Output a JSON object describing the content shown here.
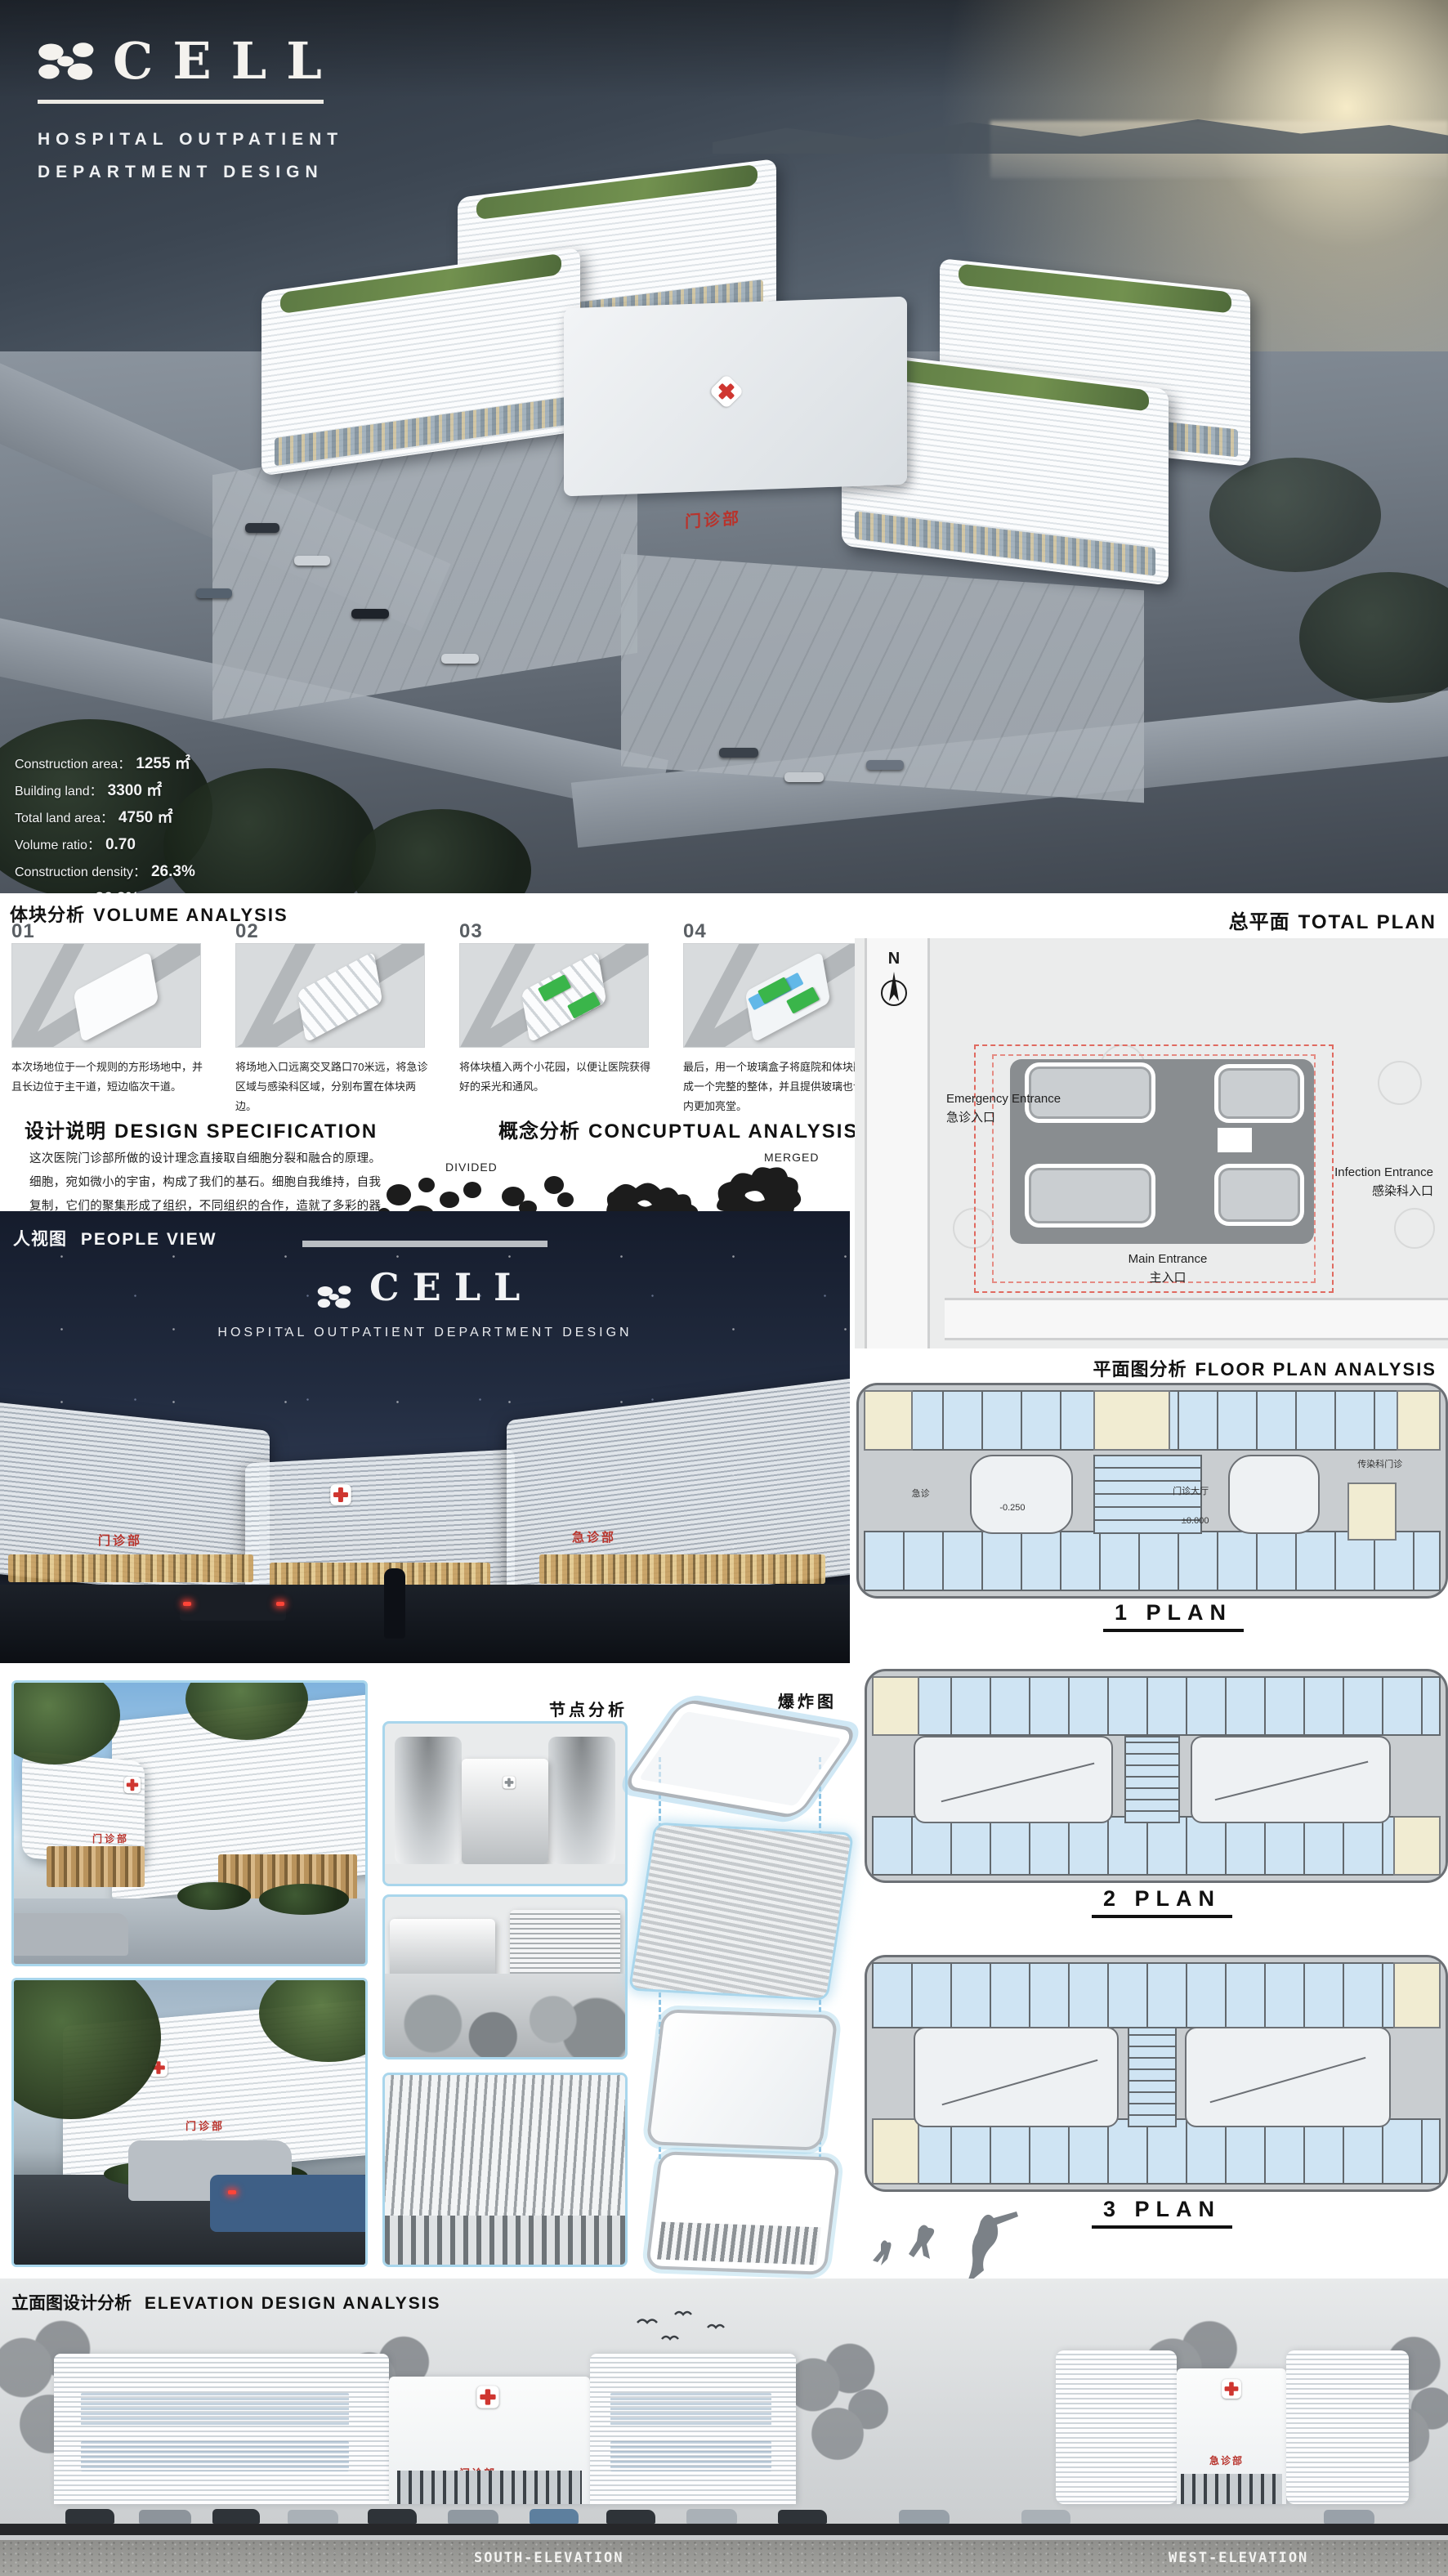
{
  "hero": {
    "logo": {
      "title": "CELL",
      "subtitle_line1": "HOSPITAL OUTPATIENT",
      "subtitle_line2": "DEPARTMENT DESIGN"
    },
    "building_sign": "门诊部",
    "stats": [
      {
        "label": "Construction area：",
        "value": "1255 ㎡"
      },
      {
        "label": "Building land：",
        "value": "3300 ㎡"
      },
      {
        "label": "Total land area：",
        "value": "4750 ㎡"
      },
      {
        "label": "Volume ratio：",
        "value": "0.70"
      },
      {
        "label": "Construction density：",
        "value": "26.3%"
      },
      {
        "label": "Green rate：",
        "value": "36.2%"
      }
    ]
  },
  "volume_analysis": {
    "title_zh": "体块分析",
    "title_en": "VOLUME ANALYSIS",
    "items": [
      {
        "num": "01",
        "caption": "本次场地位于一个规则的方形场地中，并且长边位于主干道，短边临次干道。"
      },
      {
        "num": "02",
        "caption": "将场地入口远离交叉路口70米远，将急诊区域与感染科区域，分别布置在体块两边。"
      },
      {
        "num": "03",
        "caption": "将体块植入两个小花园，以便让医院获得好的采光和通风。"
      },
      {
        "num": "04",
        "caption": "最后，用一个玻璃盒子将庭院和体块融合成一个完整的整体，并且提供玻璃也让室内更加亮堂。"
      }
    ]
  },
  "design_spec": {
    "title_zh": "设计说明",
    "title_en": "DESIGN SPECIFICATION",
    "body": "这次医院门诊部所做的设计理念直接取自细胞分裂和融合的原理。细胞，宛如微小的宇宙，构成了我们的基石。细胞自我维持，自我复制，它们的聚集形成了组织，不同组织的合作，造就了多彩的器官。受细胞合并的美学和形式语言的启发，这个门诊部有四部分组成，但看起来是一个连贯的整体。外表皮采用可智能控式的平行条形格栅，在不太太阳照度下，更有效室的给室内提供遮阳。"
  },
  "conceptual": {
    "title_zh": "概念分析",
    "title_en": "CONCUPTUAL ANALYSIS",
    "label_start": "DIVIDED",
    "label_end": "MERGED"
  },
  "total_plan": {
    "title_zh": "总平面",
    "title_en": "TOTAL PLAN",
    "north": "N",
    "emergency_en": "Emergency Entrance",
    "emergency_zh": "急诊入口",
    "infection_en": "Infection Entrance",
    "infection_zh": "感染科入口",
    "main_en": "Main Entrance",
    "main_zh": "主入口"
  },
  "people_view": {
    "title_zh": "人视图",
    "title_en": "PEOPLE VIEW",
    "logo": "CELL",
    "subtitle": "HOSPITAL OUTPATIENT DEPARTMENT DESIGN",
    "sign_left": "门诊部",
    "sign_right": "急诊部"
  },
  "floor_plans": {
    "title_zh": "平面图分析",
    "title_en": "FLOOR PLAN ANALYSIS",
    "plan1": "1 PLAN",
    "plan2": "2 PLAN",
    "plan3": "3 PLAN",
    "plan1_labels": {
      "left": "急诊",
      "hall": "门诊大厅",
      "right": "传染科门诊",
      "level0": "±0.000",
      "level1": "-0.250"
    }
  },
  "node_analysis": {
    "title": "节点分析"
  },
  "exploded": {
    "title": "爆炸图"
  },
  "renders": {
    "sign_entrance": "门诊部"
  },
  "elevation": {
    "title_zh": "立面图设计分析",
    "title_en": "ELEVATION DESIGN ANALYSIS",
    "south": "SOUTH-ELEVATION",
    "west": "WEST-ELEVATION",
    "sign_south": "门诊部",
    "sign_west": "急诊部"
  },
  "colors": {
    "accent_blue": "#a9d6ec",
    "red": "#cf3630",
    "plan_room": "#cfe4f3",
    "plan_core": "#f1ecd2"
  }
}
